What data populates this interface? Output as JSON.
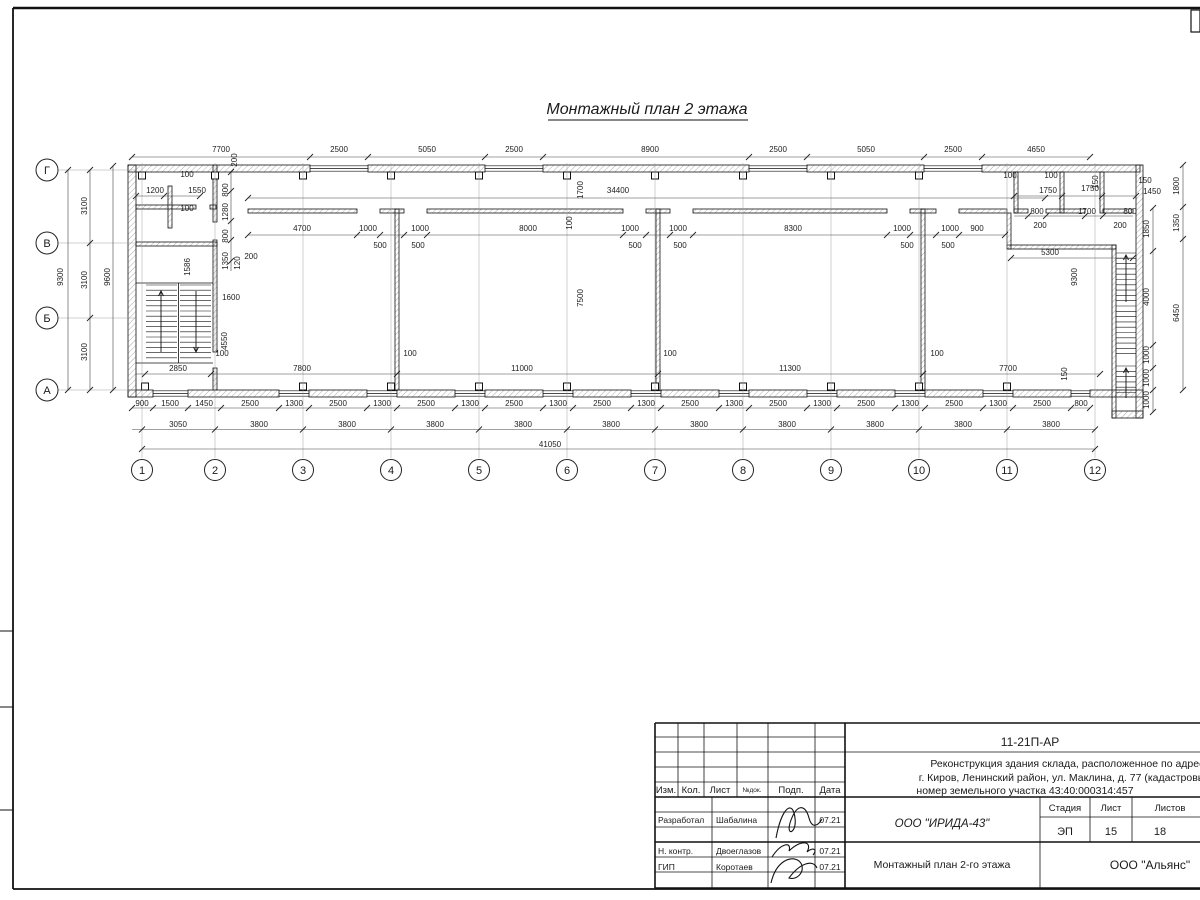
{
  "drawing": {
    "title": "Монтажный план 2 этажа",
    "axis_letters": [
      "Г",
      "В",
      "Б",
      "А"
    ],
    "axis_numbers": [
      "1",
      "2",
      "3",
      "4",
      "5",
      "6",
      "7",
      "8",
      "9",
      "10",
      "11",
      "12"
    ],
    "dims": {
      "top_row": [
        "7700",
        "2500",
        "5050",
        "2500",
        "8900",
        "2500",
        "5050",
        "2500",
        "4650"
      ],
      "corridor": [
        "200",
        "34400",
        "1700",
        "100"
      ],
      "room_widths": [
        "4700",
        "1000",
        "1000",
        "8000",
        "1000",
        "1000",
        "8300",
        "1000",
        "1000",
        "900"
      ],
      "door_offsets": [
        "500",
        "500",
        "500",
        "500",
        "500",
        "500"
      ],
      "hall_depth": [
        "7500",
        "9300",
        "5300"
      ],
      "left_rooms": [
        "100",
        "1200",
        "1550",
        "100",
        "800",
        "1280",
        "800",
        "1350",
        "120",
        "200",
        "1586",
        "1600",
        "4550",
        "100",
        "2850"
      ],
      "right_rooms": [
        "100",
        "100",
        "1750",
        "1750",
        "150",
        "150",
        "1450",
        "800",
        "1700",
        "800",
        "200",
        "200",
        "1800",
        "1850",
        "1350",
        "4000",
        "6450",
        "1000",
        "1000",
        "1000"
      ],
      "bottom_inner": [
        "7800",
        "100",
        "11000",
        "100",
        "11300",
        "100",
        "7700",
        "150"
      ],
      "bottom_row1": [
        "900",
        "1500",
        "1450",
        "2500",
        "1300",
        "2500",
        "1300",
        "2500",
        "1300",
        "2500",
        "1300",
        "2500",
        "1300",
        "2500",
        "1300",
        "2500",
        "1300",
        "2500",
        "1300",
        "2500",
        "1300",
        "2500",
        "800"
      ],
      "bottom_row2": [
        "3050",
        "3800",
        "3800",
        "3800",
        "3800",
        "3800",
        "3800",
        "3800",
        "3800",
        "3800",
        "3800"
      ],
      "total_length": [
        "41050"
      ],
      "left_col": [
        "9300",
        "3100",
        "3100",
        "3100",
        "9600"
      ]
    }
  },
  "title_block": {
    "code": "11-21П-АР",
    "project_lines": [
      "Реконструкция здания склада, расположенное по адресу",
      "г. Киров, Ленинский район, ул. Маклина, д. 77 (кадастровый",
      "номер земельного участка 43:40:000314:457"
    ],
    "org": "ООО \"ИРИДА-43\"",
    "doc_title": "Монтажный план 2-го этажа",
    "company": "ООО \"Альянс\"",
    "stage_label": "Стадия",
    "sheet_label": "Лист",
    "sheets_label": "Листов",
    "stage": "ЭП",
    "sheet_number": "15",
    "sheets_total": "18",
    "header_cols": [
      "Изм.",
      "Кол.",
      "Лист",
      "№док.",
      "Подп.",
      "Дата"
    ],
    "roles": [
      {
        "role": "Разработал",
        "name": "Шабалина",
        "date": "07.21"
      },
      {
        "role": "Н. контр.",
        "name": "Двоеглазов",
        "date": "07.21"
      },
      {
        "role": "ГИП",
        "name": "Коротаев",
        "date": "07.21"
      }
    ]
  }
}
